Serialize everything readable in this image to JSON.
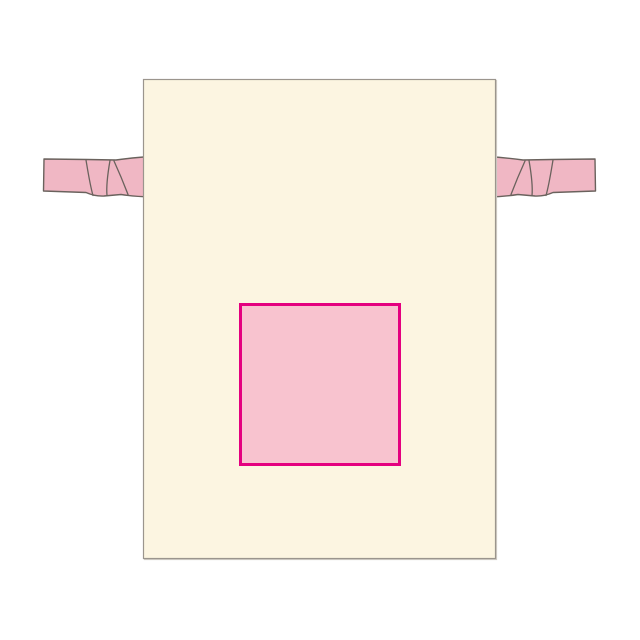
{
  "page": {
    "background": "#ffffff"
  },
  "mockup": {
    "item": "drawstring-pouch",
    "view": "front",
    "colors": {
      "bag_fill": "#fcf5e1",
      "bag_outline": "#9b958d",
      "bag_shadow": "#cfcbc5",
      "ribbon_fill": "#f0b7c4",
      "ribbon_outline": "#6a625d",
      "print_area_fill": "#f8c3cf",
      "print_area_border": "#e4007f"
    }
  }
}
